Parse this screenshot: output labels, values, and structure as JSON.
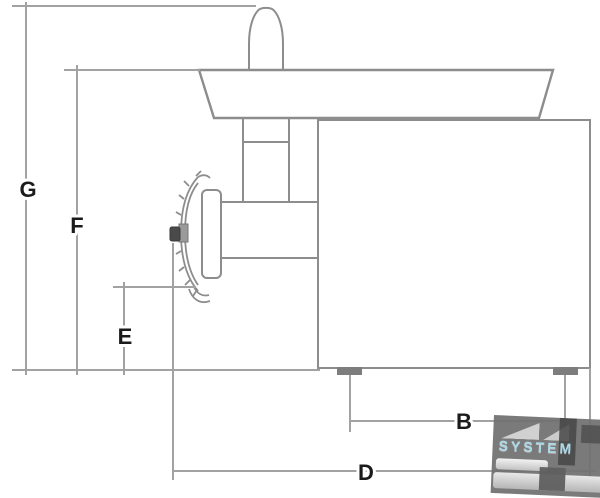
{
  "diagram": {
    "description": "Side-view technical line drawing of a meat grinder with dimension callouts",
    "dimensions": {
      "G": {
        "label": "G",
        "meaning": "overall height incl. pusher"
      },
      "F": {
        "label": "F",
        "meaning": "height to tray top"
      },
      "E": {
        "label": "E",
        "meaning": "clearance under grinder head"
      },
      "B": {
        "label": "B",
        "meaning": "distance between feet"
      },
      "D": {
        "label": "D",
        "meaning": "overall depth"
      }
    }
  },
  "watermark": {
    "text": "SYSTEM"
  },
  "colors": {
    "outline": "#8d8d8d",
    "dim_line": "#a2a2a2",
    "label": "#1b1b1b",
    "knob_dark": "#4a4a4a",
    "foot": "#7d7d7d",
    "watermark_text": "#a9d8e8",
    "background": "#ffffff"
  }
}
